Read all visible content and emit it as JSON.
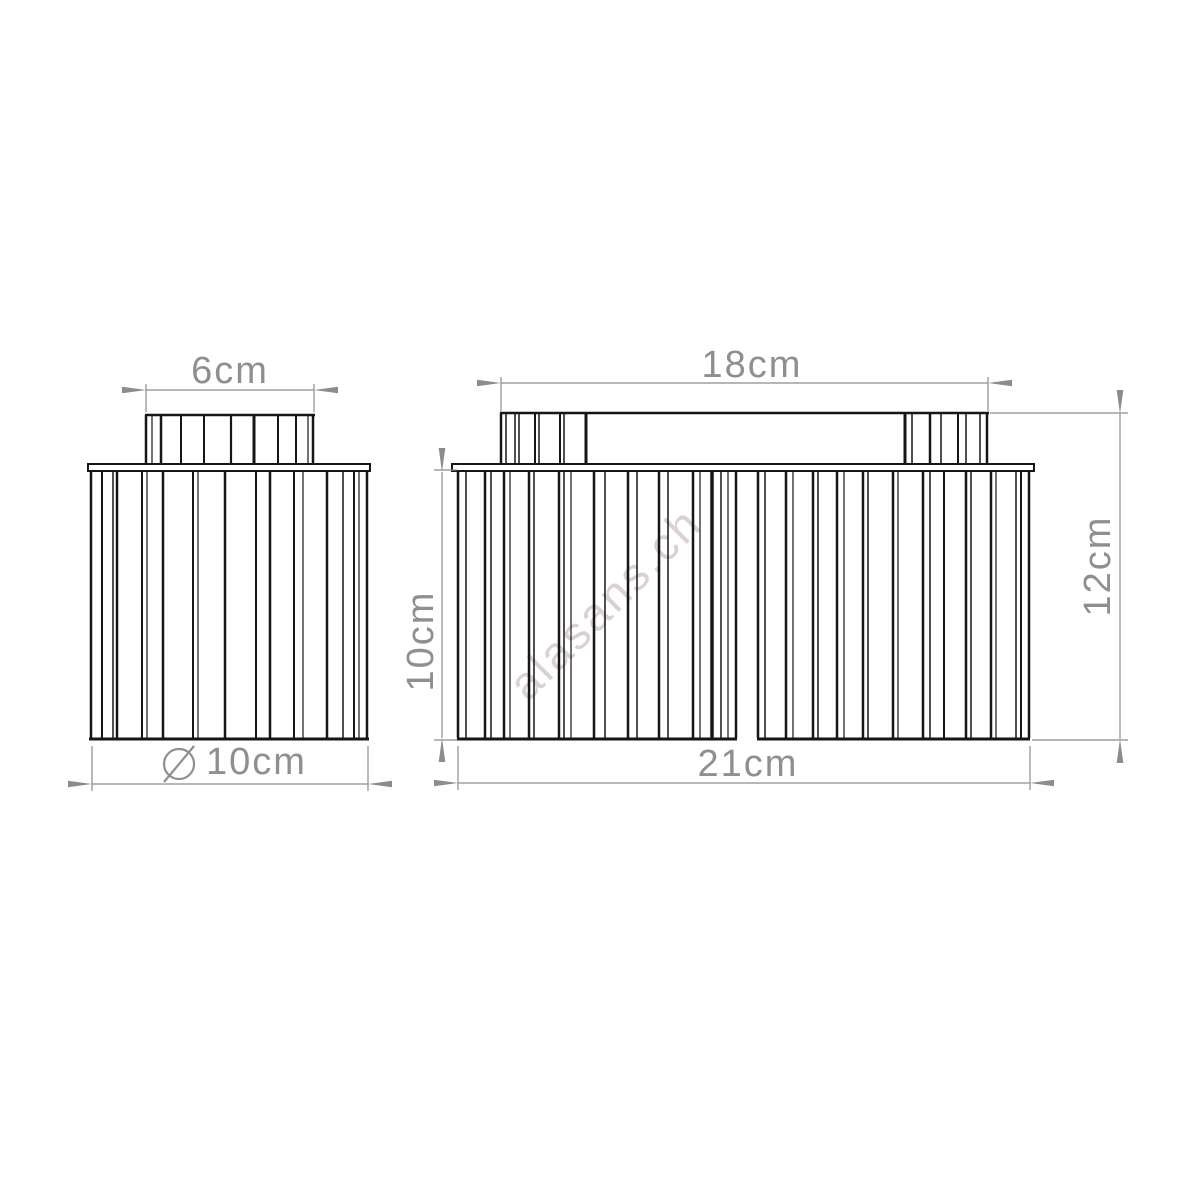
{
  "watermark": {
    "text": "alasans.ch"
  },
  "labels": {
    "left_view": {
      "top_width": "6cm",
      "bottom_diameter": {
        "symbol": "⌀",
        "value": "10cm"
      }
    },
    "right_view": {
      "top_width": "18cm",
      "bottom_width": "21cm",
      "shade_height": "10cm",
      "total_height": "12cm"
    }
  },
  "drawing": {
    "line_color": "#161616",
    "dim_color": "#8c8c8c",
    "left_view": {
      "knob": {
        "x1": 146,
        "x2": 314,
        "y_top": 415,
        "y_bottom": 464,
        "top_edge": true,
        "stripes": [
          [
            146,
            2.5
          ],
          [
            152,
            1.2
          ],
          [
            161,
            2.5
          ],
          [
            181,
            2
          ],
          [
            204,
            2
          ],
          [
            231,
            2.2
          ],
          [
            254,
            3
          ],
          [
            278,
            2
          ],
          [
            296,
            2
          ],
          [
            308,
            1.2
          ],
          [
            313,
            2.5
          ]
        ]
      },
      "canopy": {
        "x": 88,
        "y": 464,
        "w": 282,
        "h": 7
      },
      "body": {
        "y_top": 472,
        "y_bottom": 738,
        "top_edge": false,
        "stripes": [
          [
            91,
            2.5
          ],
          [
            102,
            2
          ],
          [
            113,
            1.5
          ],
          [
            117,
            2.5
          ],
          [
            142,
            2
          ],
          [
            147,
            1.2
          ],
          [
            163,
            2.5
          ],
          [
            193,
            2
          ],
          [
            198,
            1.2
          ],
          [
            225,
            2.5
          ],
          [
            256,
            2
          ],
          [
            270,
            2.5
          ],
          [
            294,
            2
          ],
          [
            303,
            1.2
          ],
          [
            327,
            2.5
          ],
          [
            343,
            1.5
          ],
          [
            354,
            2
          ],
          [
            359,
            1.2
          ],
          [
            367,
            2.5
          ]
        ],
        "bottom_segments": [
          [
            89,
            369
          ]
        ]
      }
    },
    "right_view": {
      "topbar": {
        "x1": 501,
        "x2": 988,
        "y_top": 413,
        "y_bottom": 464,
        "top_edge": true,
        "stripes": [
          [
            501,
            2.5
          ],
          [
            506,
            1.5
          ],
          [
            515,
            1.5
          ],
          [
            519,
            1.5
          ],
          [
            535,
            2
          ],
          [
            539,
            1.5
          ],
          [
            560,
            2
          ],
          [
            564,
            1.5
          ],
          [
            586,
            3
          ],
          [
            905,
            3
          ],
          [
            912,
            1.5
          ],
          [
            930,
            2.5
          ],
          [
            941,
            1.5
          ],
          [
            958,
            2
          ],
          [
            966,
            1.5
          ],
          [
            980,
            1.5
          ],
          [
            987,
            2.5
          ]
        ]
      },
      "canopy": {
        "x": 452,
        "y": 464,
        "w": 582,
        "h": 7
      },
      "body": {
        "y_top": 472,
        "y_bottom": 738,
        "top_edge": false,
        "stripes": [
          [
            458,
            2.5
          ],
          [
            466,
            1.5
          ],
          [
            485,
            2.5
          ],
          [
            491,
            1.5
          ],
          [
            504,
            2.5
          ],
          [
            510,
            1.2
          ],
          [
            529,
            2.5
          ],
          [
            534,
            1.5
          ],
          [
            559,
            2.5
          ],
          [
            564,
            1.5
          ],
          [
            571,
            1.2
          ],
          [
            594,
            2.5
          ],
          [
            605,
            1.5
          ],
          [
            628,
            2.5
          ],
          [
            637,
            1.5
          ],
          [
            659,
            2.5
          ],
          [
            668,
            1.5
          ],
          [
            693,
            2.5
          ],
          [
            700,
            1.2
          ],
          [
            712,
            3.5
          ],
          [
            721,
            1.5
          ],
          [
            728,
            1.2
          ],
          [
            736,
            2.5
          ],
          [
            758,
            2.5
          ],
          [
            765,
            1.5
          ],
          [
            786,
            2.5
          ],
          [
            793,
            1.2
          ],
          [
            813,
            2.5
          ],
          [
            818,
            1.5
          ],
          [
            837,
            2.5
          ],
          [
            844,
            1.2
          ],
          [
            863,
            2.5
          ],
          [
            868,
            1.5
          ],
          [
            893,
            2.5
          ],
          [
            898,
            1.2
          ],
          [
            923,
            2.5
          ],
          [
            930,
            1.5
          ],
          [
            944,
            2
          ],
          [
            966,
            2.5
          ],
          [
            971,
            1.5
          ],
          [
            991,
            2.5
          ],
          [
            996,
            1.2
          ],
          [
            1016,
            1.5
          ],
          [
            1021,
            2
          ],
          [
            1029,
            2.5
          ]
        ],
        "bottom_segments": [
          [
            457,
            737
          ],
          [
            757,
            1030
          ]
        ]
      }
    },
    "dims": {
      "horizontal": [
        {
          "y": 390,
          "x1": 146,
          "x2": 314,
          "ext": [
            [
              146,
              384,
              412
            ],
            [
              314,
              384,
              412
            ]
          ]
        },
        {
          "y": 784,
          "x1": 92,
          "x2": 368,
          "ext": [
            [
              92,
              746,
              791
            ],
            [
              368,
              746,
              791
            ]
          ]
        },
        {
          "y": 383,
          "x1": 501,
          "x2": 988,
          "ext": [
            [
              501,
              377,
              411
            ],
            [
              988,
              377,
              411
            ]
          ]
        },
        {
          "y": 783,
          "x1": 458,
          "x2": 1030,
          "ext": [
            [
              458,
              746,
              790
            ],
            [
              1030,
              746,
              790
            ]
          ]
        }
      ],
      "vertical": [
        {
          "x": 442,
          "y1": 472,
          "y2": 738,
          "ext": [
            [
              470,
              434,
              457
            ],
            [
              740,
              434,
              457
            ]
          ]
        },
        {
          "x": 1120,
          "y1": 414,
          "y2": 739,
          "ext": [
            [
              413,
              990,
              1128
            ],
            [
              740,
              1032,
              1128
            ]
          ]
        }
      ]
    }
  }
}
